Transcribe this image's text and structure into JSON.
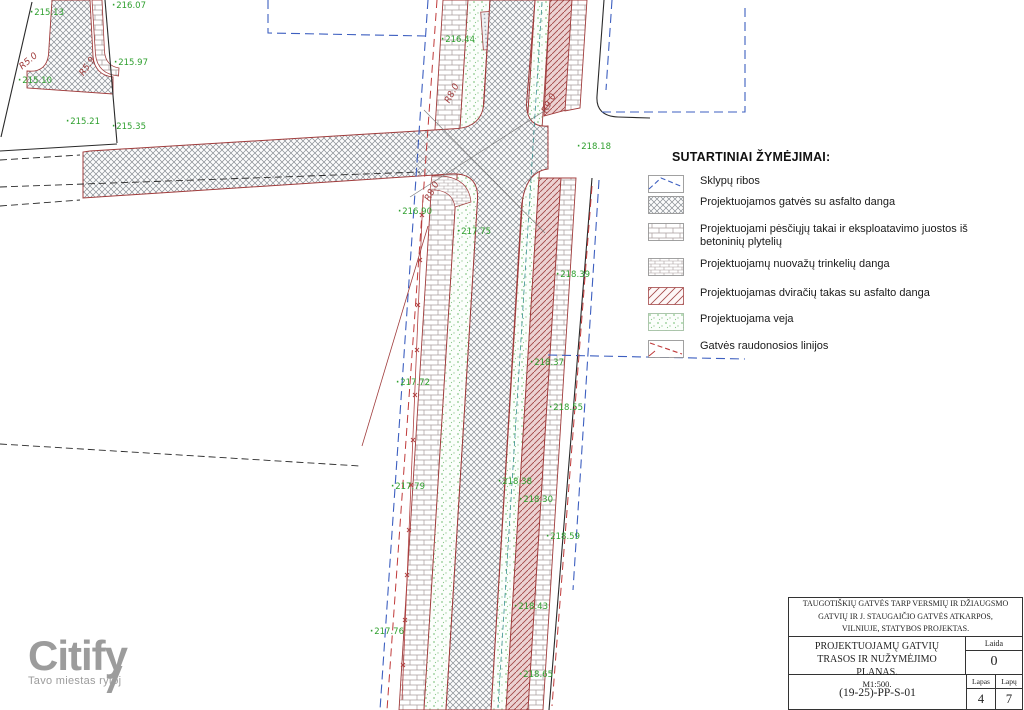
{
  "legend": {
    "title": "SUTARTINIAI ŽYMĖJIMAI:",
    "items": [
      {
        "swatch": "parcel-boundary",
        "label": "Sklypų ribos"
      },
      {
        "swatch": "asphalt-street",
        "label": "Projektuojamos gatvės su asfalto danga"
      },
      {
        "swatch": "concrete-tile-paths",
        "label": "Projektuojami pėsčiųjų takai ir eksploatavimo juostos iš betoninių plytelių"
      },
      {
        "swatch": "driveway-pavers",
        "label": "Projektuojamų nuovažų trinkelių danga"
      },
      {
        "swatch": "bike-path-asphalt",
        "label": "Projektuojamas dviračių takas su asfalto danga"
      },
      {
        "swatch": "lawn",
        "label": "Projektuojama veja"
      },
      {
        "swatch": "street-red-lines",
        "label": "Gatvės raudonosios linijos"
      }
    ]
  },
  "title_block": {
    "project": "TAUGOTIŠKIŲ GATVĖS TARP VERSMIŲ IR DŽIAUGSMO GATVIŲ IR J. STAUGAIČIO GATVĖS ATKARPOS, VILNIUJE, STATYBOS PROJEKTAS.",
    "drawing_title": "PROJEKTUOJAMŲ GATVIŲ TRASOS IR NUŽYMĖJIMO PLANAS.",
    "scale": "M1:500.",
    "laida_label": "Laida",
    "laida_value": "0",
    "doc_number": "(19-25)-PP-S-01",
    "lapas_label": "Lapas",
    "lapas_value": "4",
    "lapu_label": "Lapų",
    "lapu_value": "7"
  },
  "logo": {
    "name": "Citify",
    "tagline": "Tavo miestas rytoj"
  },
  "plan": {
    "colors": {
      "red_line": "#a03c3c",
      "green_label": "#2fa02f",
      "blue_boundary": "#3d5fc0",
      "black_line": "#2a2a2a"
    },
    "elevation_labels": [
      {
        "text": "215.13",
        "x": 30,
        "y": 8
      },
      {
        "text": "216.07",
        "x": 112,
        "y": 1
      },
      {
        "text": "215.97",
        "x": 114,
        "y": 58
      },
      {
        "text": "215.10",
        "x": 18,
        "y": 76
      },
      {
        "text": "215.21",
        "x": 66,
        "y": 117
      },
      {
        "text": "215.35",
        "x": 112,
        "y": 122
      },
      {
        "text": "216.44",
        "x": 441,
        "y": 35
      },
      {
        "text": "218.18",
        "x": 577,
        "y": 142
      },
      {
        "text": "216.90",
        "x": 398,
        "y": 207
      },
      {
        "text": "217.75",
        "x": 457,
        "y": 227
      },
      {
        "text": "218.39",
        "x": 556,
        "y": 270
      },
      {
        "text": "218.37",
        "x": 530,
        "y": 358
      },
      {
        "text": "217.72",
        "x": 396,
        "y": 378
      },
      {
        "text": "218.55",
        "x": 549,
        "y": 403
      },
      {
        "text": "218.38",
        "x": 498,
        "y": 477
      },
      {
        "text": "217.79",
        "x": 391,
        "y": 482
      },
      {
        "text": "218.30",
        "x": 519,
        "y": 495
      },
      {
        "text": "218.59",
        "x": 546,
        "y": 532
      },
      {
        "text": "218.43",
        "x": 514,
        "y": 602
      },
      {
        "text": "217.76",
        "x": 370,
        "y": 627
      },
      {
        "text": "218.65",
        "x": 519,
        "y": 670
      }
    ],
    "radius_labels": [
      {
        "text": "R5.0",
        "x": 24,
        "y": 62,
        "rot": -40
      },
      {
        "text": "R5.9",
        "x": 86,
        "y": 68,
        "rot": -55
      },
      {
        "text": "R8.0",
        "x": 452,
        "y": 95,
        "rot": -62
      },
      {
        "text": "R9.0",
        "x": 549,
        "y": 105,
        "rot": -62
      },
      {
        "text": "R8.0",
        "x": 432,
        "y": 193,
        "rot": -62
      }
    ]
  }
}
